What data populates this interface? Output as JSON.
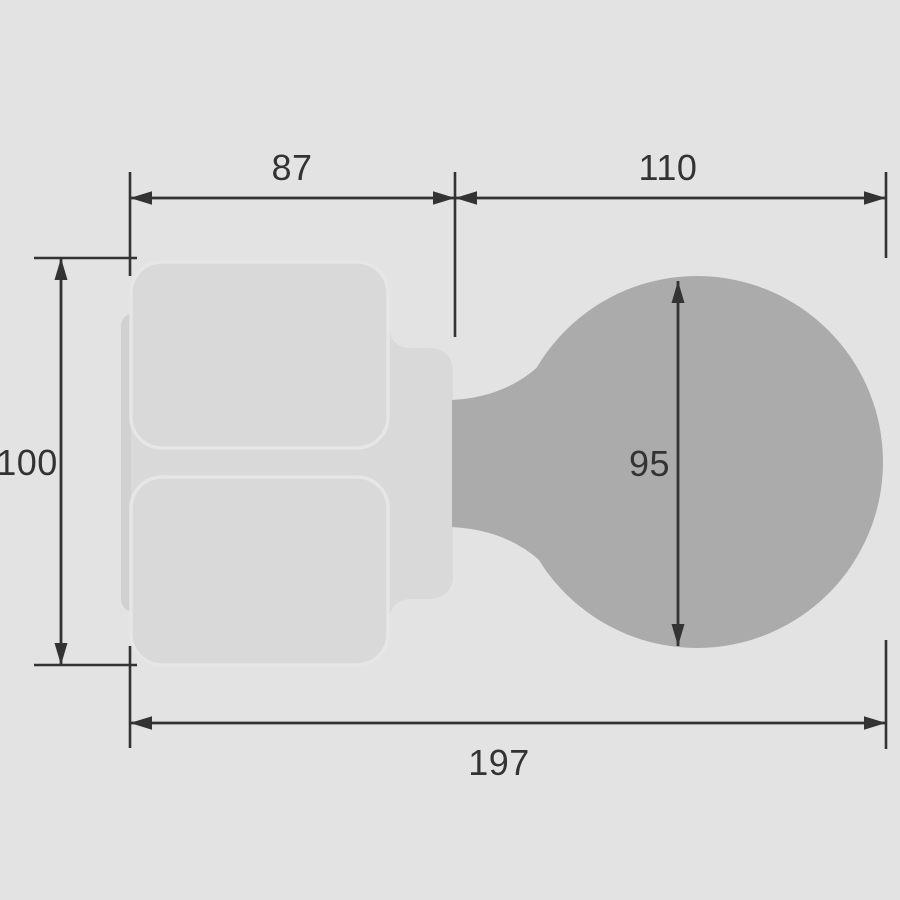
{
  "title": "Knob dimension drawing",
  "colors": {
    "background": "#e3e3e3",
    "plate": "#d9d9d9",
    "plate_edge": "#d1d1d1",
    "plate_stroke": "#e6e6e6",
    "knob": "#ababab",
    "line": "#333333",
    "text": "#333333"
  },
  "dimensions": {
    "plate_width": "87",
    "knob_depth": "110",
    "plate_height": "100",
    "knob_diameter": "95",
    "total_depth": "197"
  }
}
